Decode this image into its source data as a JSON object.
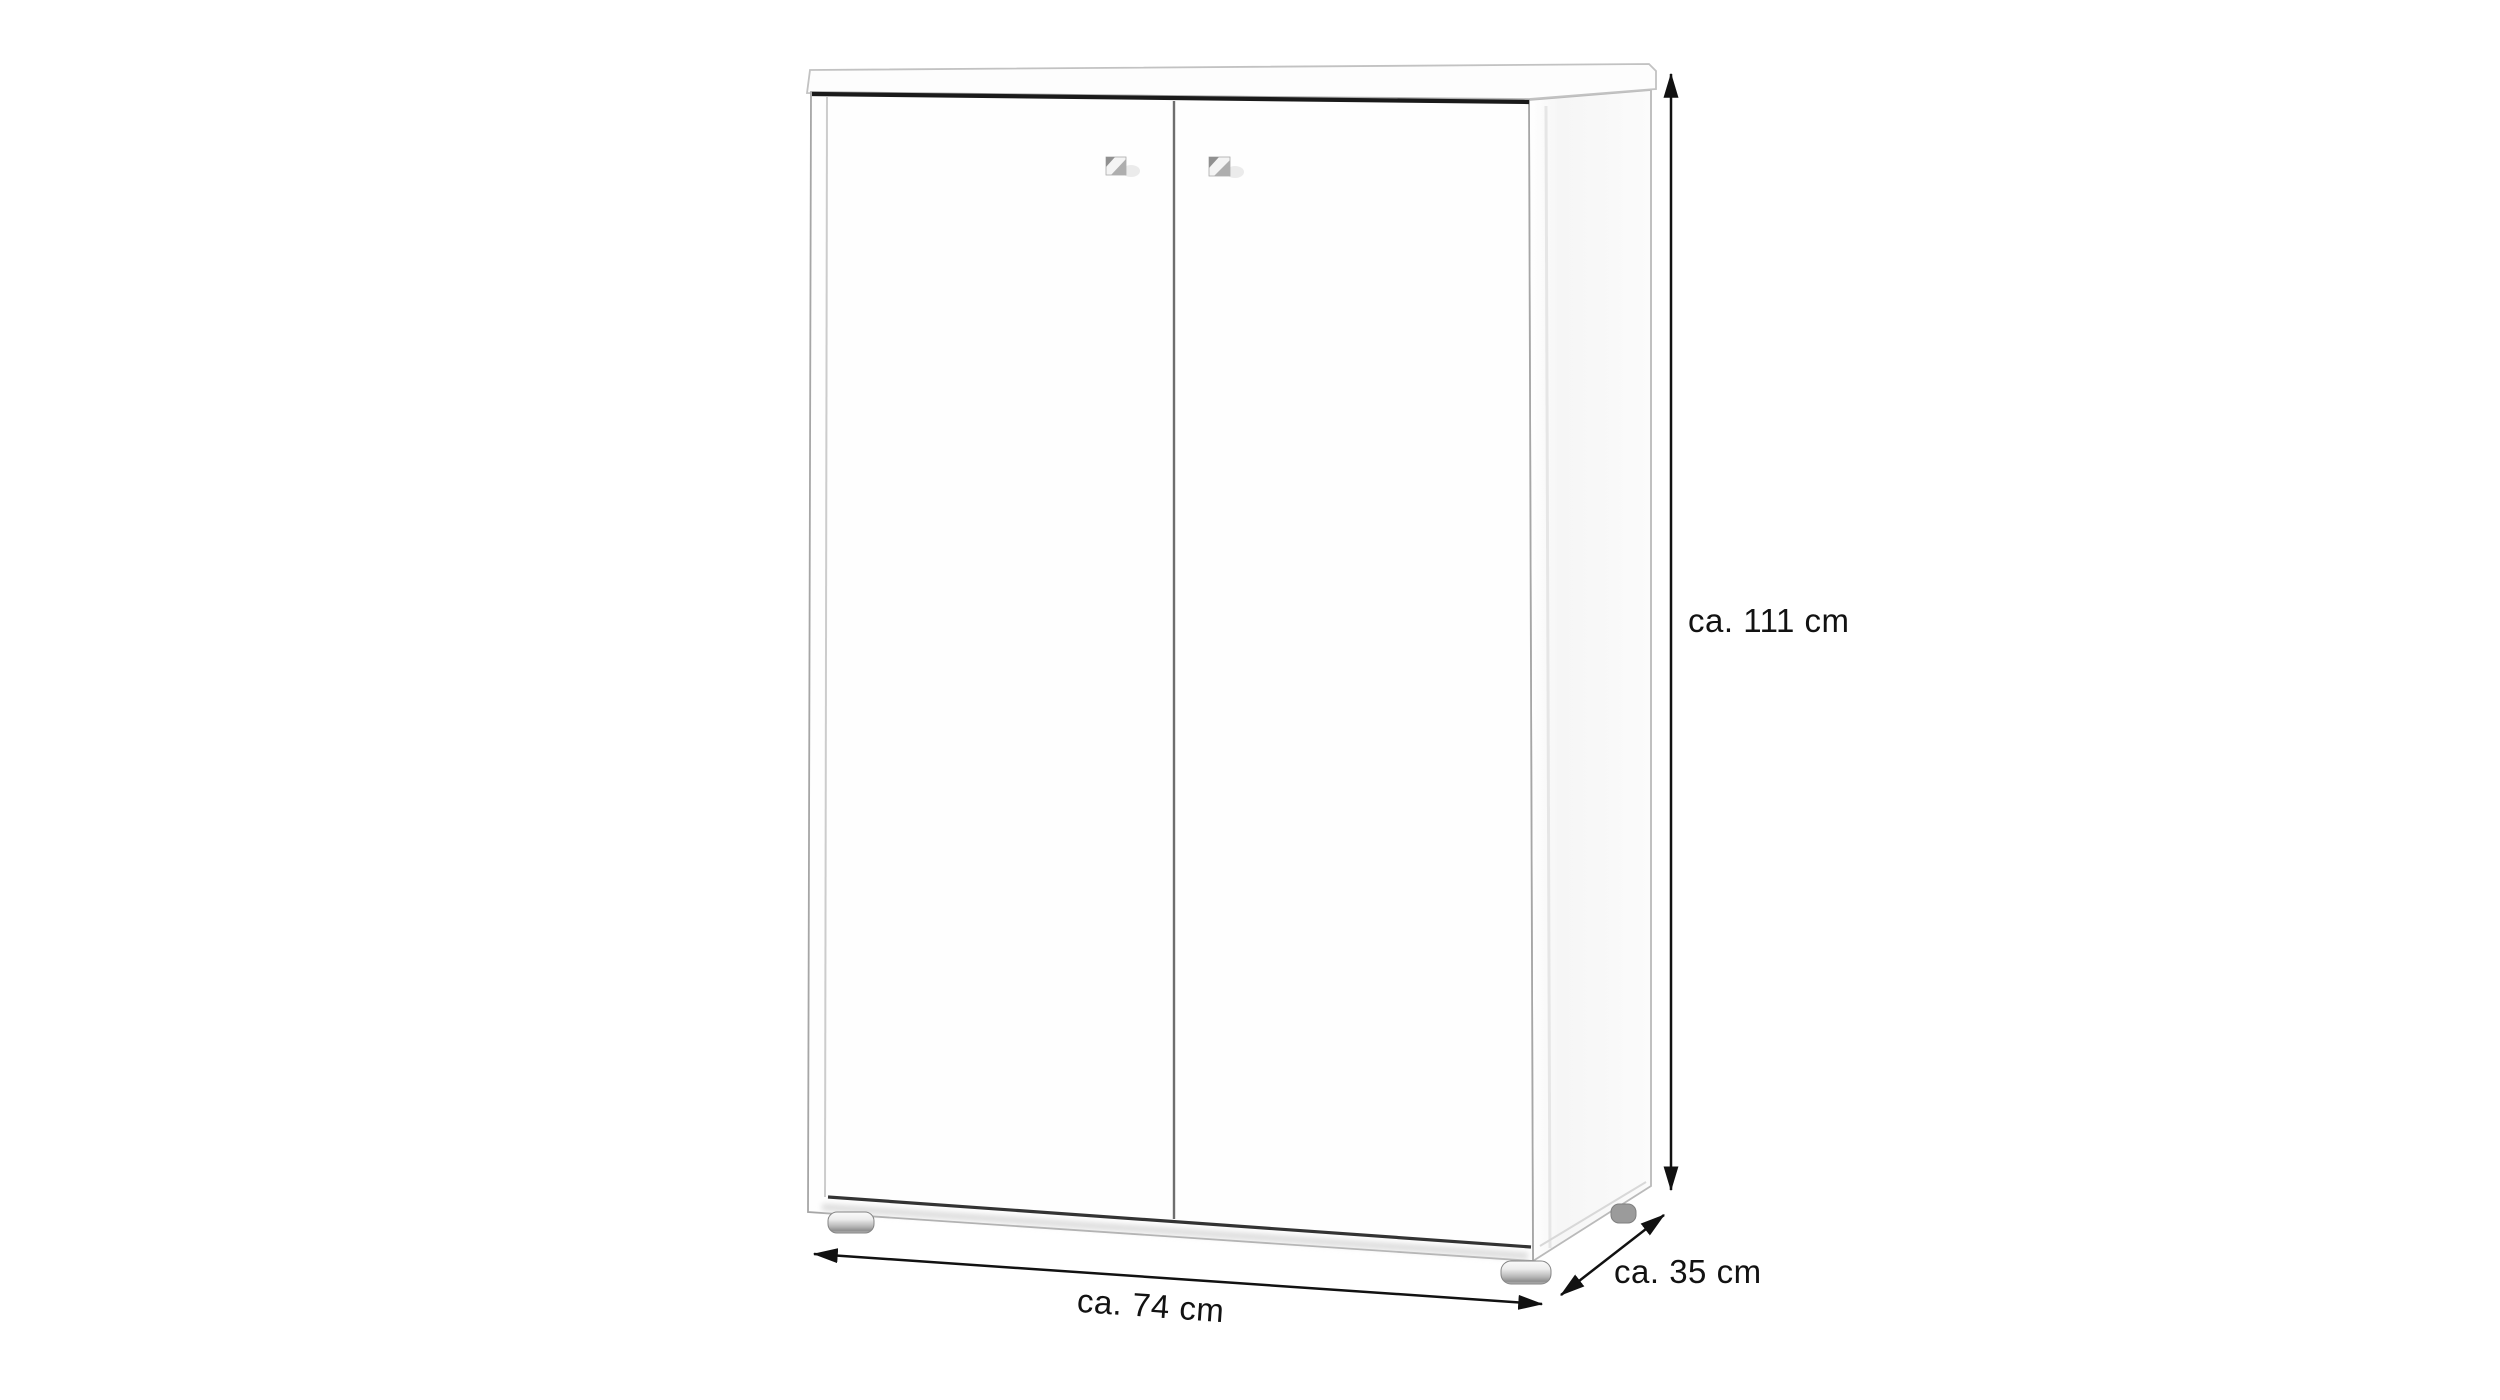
{
  "diagram": {
    "dimensions": {
      "height": {
        "label": "ca. 111 cm"
      },
      "width": {
        "label": "ca. 74 cm"
      },
      "depth": {
        "label": "ca. 35 cm"
      }
    },
    "colors": {
      "background": "#ffffff",
      "cabinet_outline": "#adadad",
      "door_gap_dark": "#1a1a1a",
      "door_divider": "#6e6e6e",
      "dimension_line": "#111111",
      "label_text": "#121212",
      "foot_metal": "#a8a8a8"
    }
  }
}
